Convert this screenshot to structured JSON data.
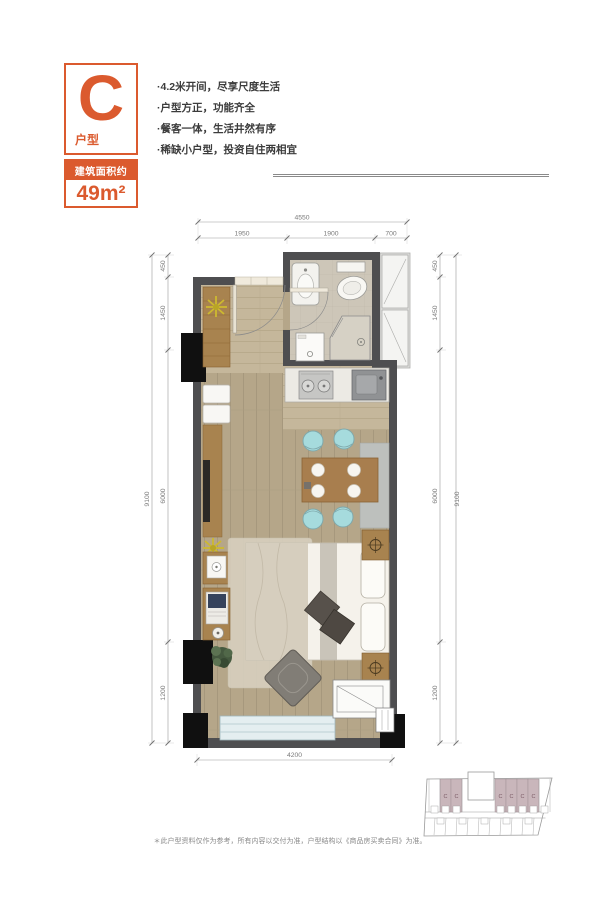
{
  "header": {
    "badge": {
      "letter": "C",
      "label": "户型"
    },
    "area": {
      "caption": "建筑面积约",
      "value": "49m²"
    },
    "selling_points": [
      "·4.2米开间，尽享尺度生活",
      "·户型方正，功能齐全",
      "·餐客一体，生活井然有序",
      "·稀缺小户型，投资自住两相宜"
    ]
  },
  "plan": {
    "dims": {
      "top_total": "4550",
      "top_segments": [
        "1950",
        "1900",
        "700"
      ],
      "side_total": "9100",
      "side_segments": [
        "450",
        "1450",
        "6000",
        "1200"
      ],
      "bottom_total": "4200"
    }
  },
  "key_plan": {
    "unit_label": "C"
  },
  "footer": {
    "disclaimer": "＊此户型资料仅作为参考，所有内容以交付为准，户型结构以《商品房买卖合同》为准。"
  },
  "colors": {
    "accent": "#DB5A2E",
    "wall": "#4E4E50",
    "floor_wood": "#B6A78A",
    "teal_chair": "#A6DBDD",
    "keyplan_highlight": "#C9B6BB"
  }
}
